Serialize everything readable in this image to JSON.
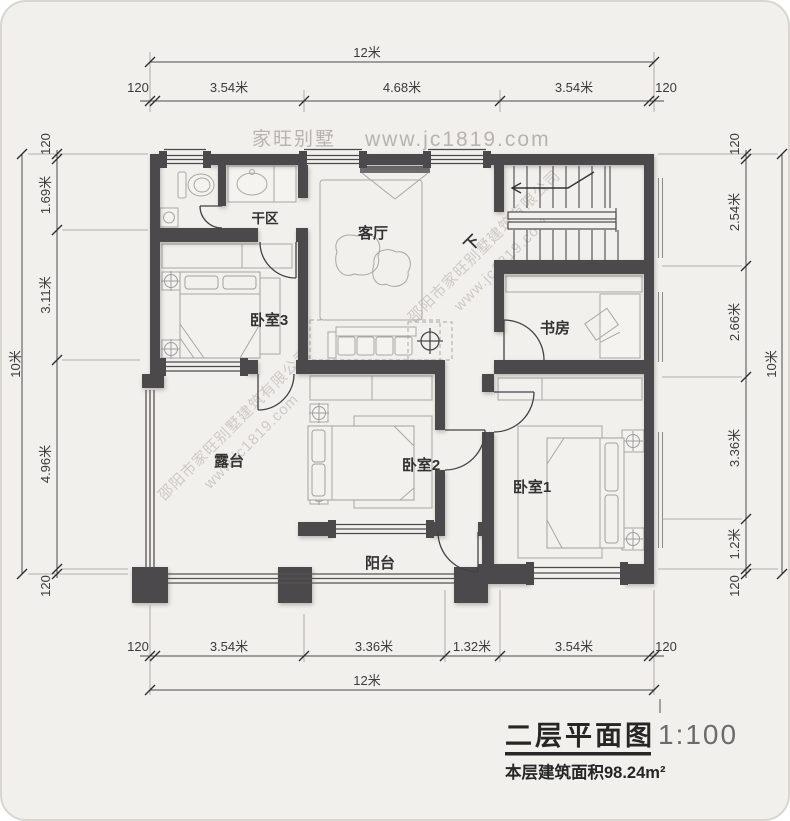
{
  "header": {
    "brand": "家旺别墅",
    "site": "www.jc1819.com"
  },
  "watermark": {
    "company": "邵阳市家旺别墅建筑有限公司",
    "site": "www.jc1819.com"
  },
  "rooms": {
    "dry_area": "干区",
    "living_room": "客厅",
    "bedroom3": "卧室3",
    "study": "书房",
    "terrace": "露台",
    "bedroom2": "卧室2",
    "bedroom1": "卧室1",
    "balcony": "阳台",
    "stairs_direction": "下"
  },
  "dims": {
    "top": {
      "total": "12米",
      "segs": [
        "120",
        "3.54米",
        "4.68米",
        "3.54米",
        "120"
      ]
    },
    "bottom": {
      "total": "12米",
      "segs": [
        "120",
        "3.54米",
        "3.36米",
        "1.32米",
        "3.54米",
        "120"
      ]
    },
    "left": {
      "total": "10米",
      "segs": [
        "120",
        "1.69米",
        "3.11米",
        "4.96米",
        "120"
      ]
    },
    "right": {
      "total": "10米",
      "segs": [
        "120",
        "2.54米",
        "2.66米",
        "3.36米",
        "1.2米",
        "120"
      ]
    }
  },
  "title_block": {
    "title": "二层平面图",
    "scale": "1:100",
    "area": "本层建筑面积98.24m²"
  },
  "colors": {
    "wall": "#4b494c",
    "background": "#f2f0ec",
    "furniture_line": "#a9a7a4",
    "watermark": "#c7c4c0",
    "dim_text": "#3a3a3a"
  }
}
